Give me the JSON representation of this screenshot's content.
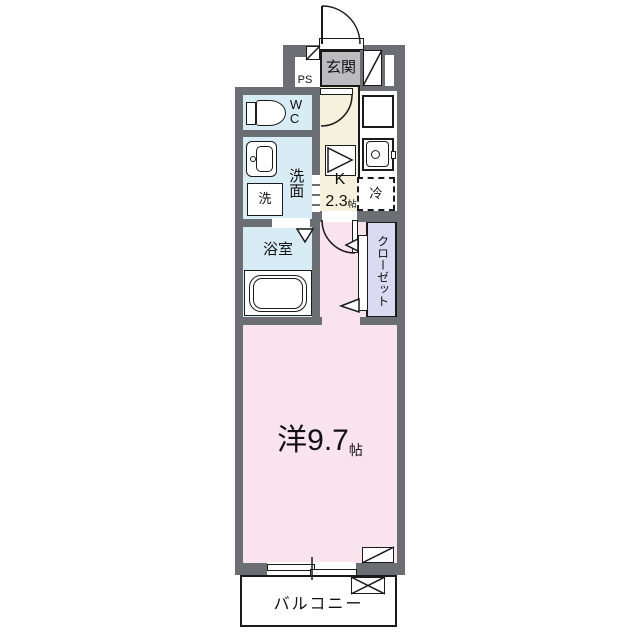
{
  "colors": {
    "paper": "#ffffff",
    "wall": "#6b6e72",
    "genkan": "#bcbcbe",
    "wet": "#d8ecf5",
    "kitchen": "#f6f1dc",
    "closet": "#dadaf3",
    "room": "#f9e3ed"
  },
  "entrance": {
    "label": "玄関",
    "pipe_space": "PS"
  },
  "wc": {
    "label": "W\nC"
  },
  "washroom": {
    "label": "洗面",
    "washer": "洗"
  },
  "bathroom": {
    "label": "浴室"
  },
  "kitchen": {
    "label": "K",
    "size": "2.3",
    "size_unit": "帖",
    "fridge": "冷"
  },
  "closet": {
    "label": "クローゼット"
  },
  "main_room": {
    "label": "洋9.7",
    "unit": "帖"
  },
  "balcony": {
    "label": "バルコニー"
  }
}
